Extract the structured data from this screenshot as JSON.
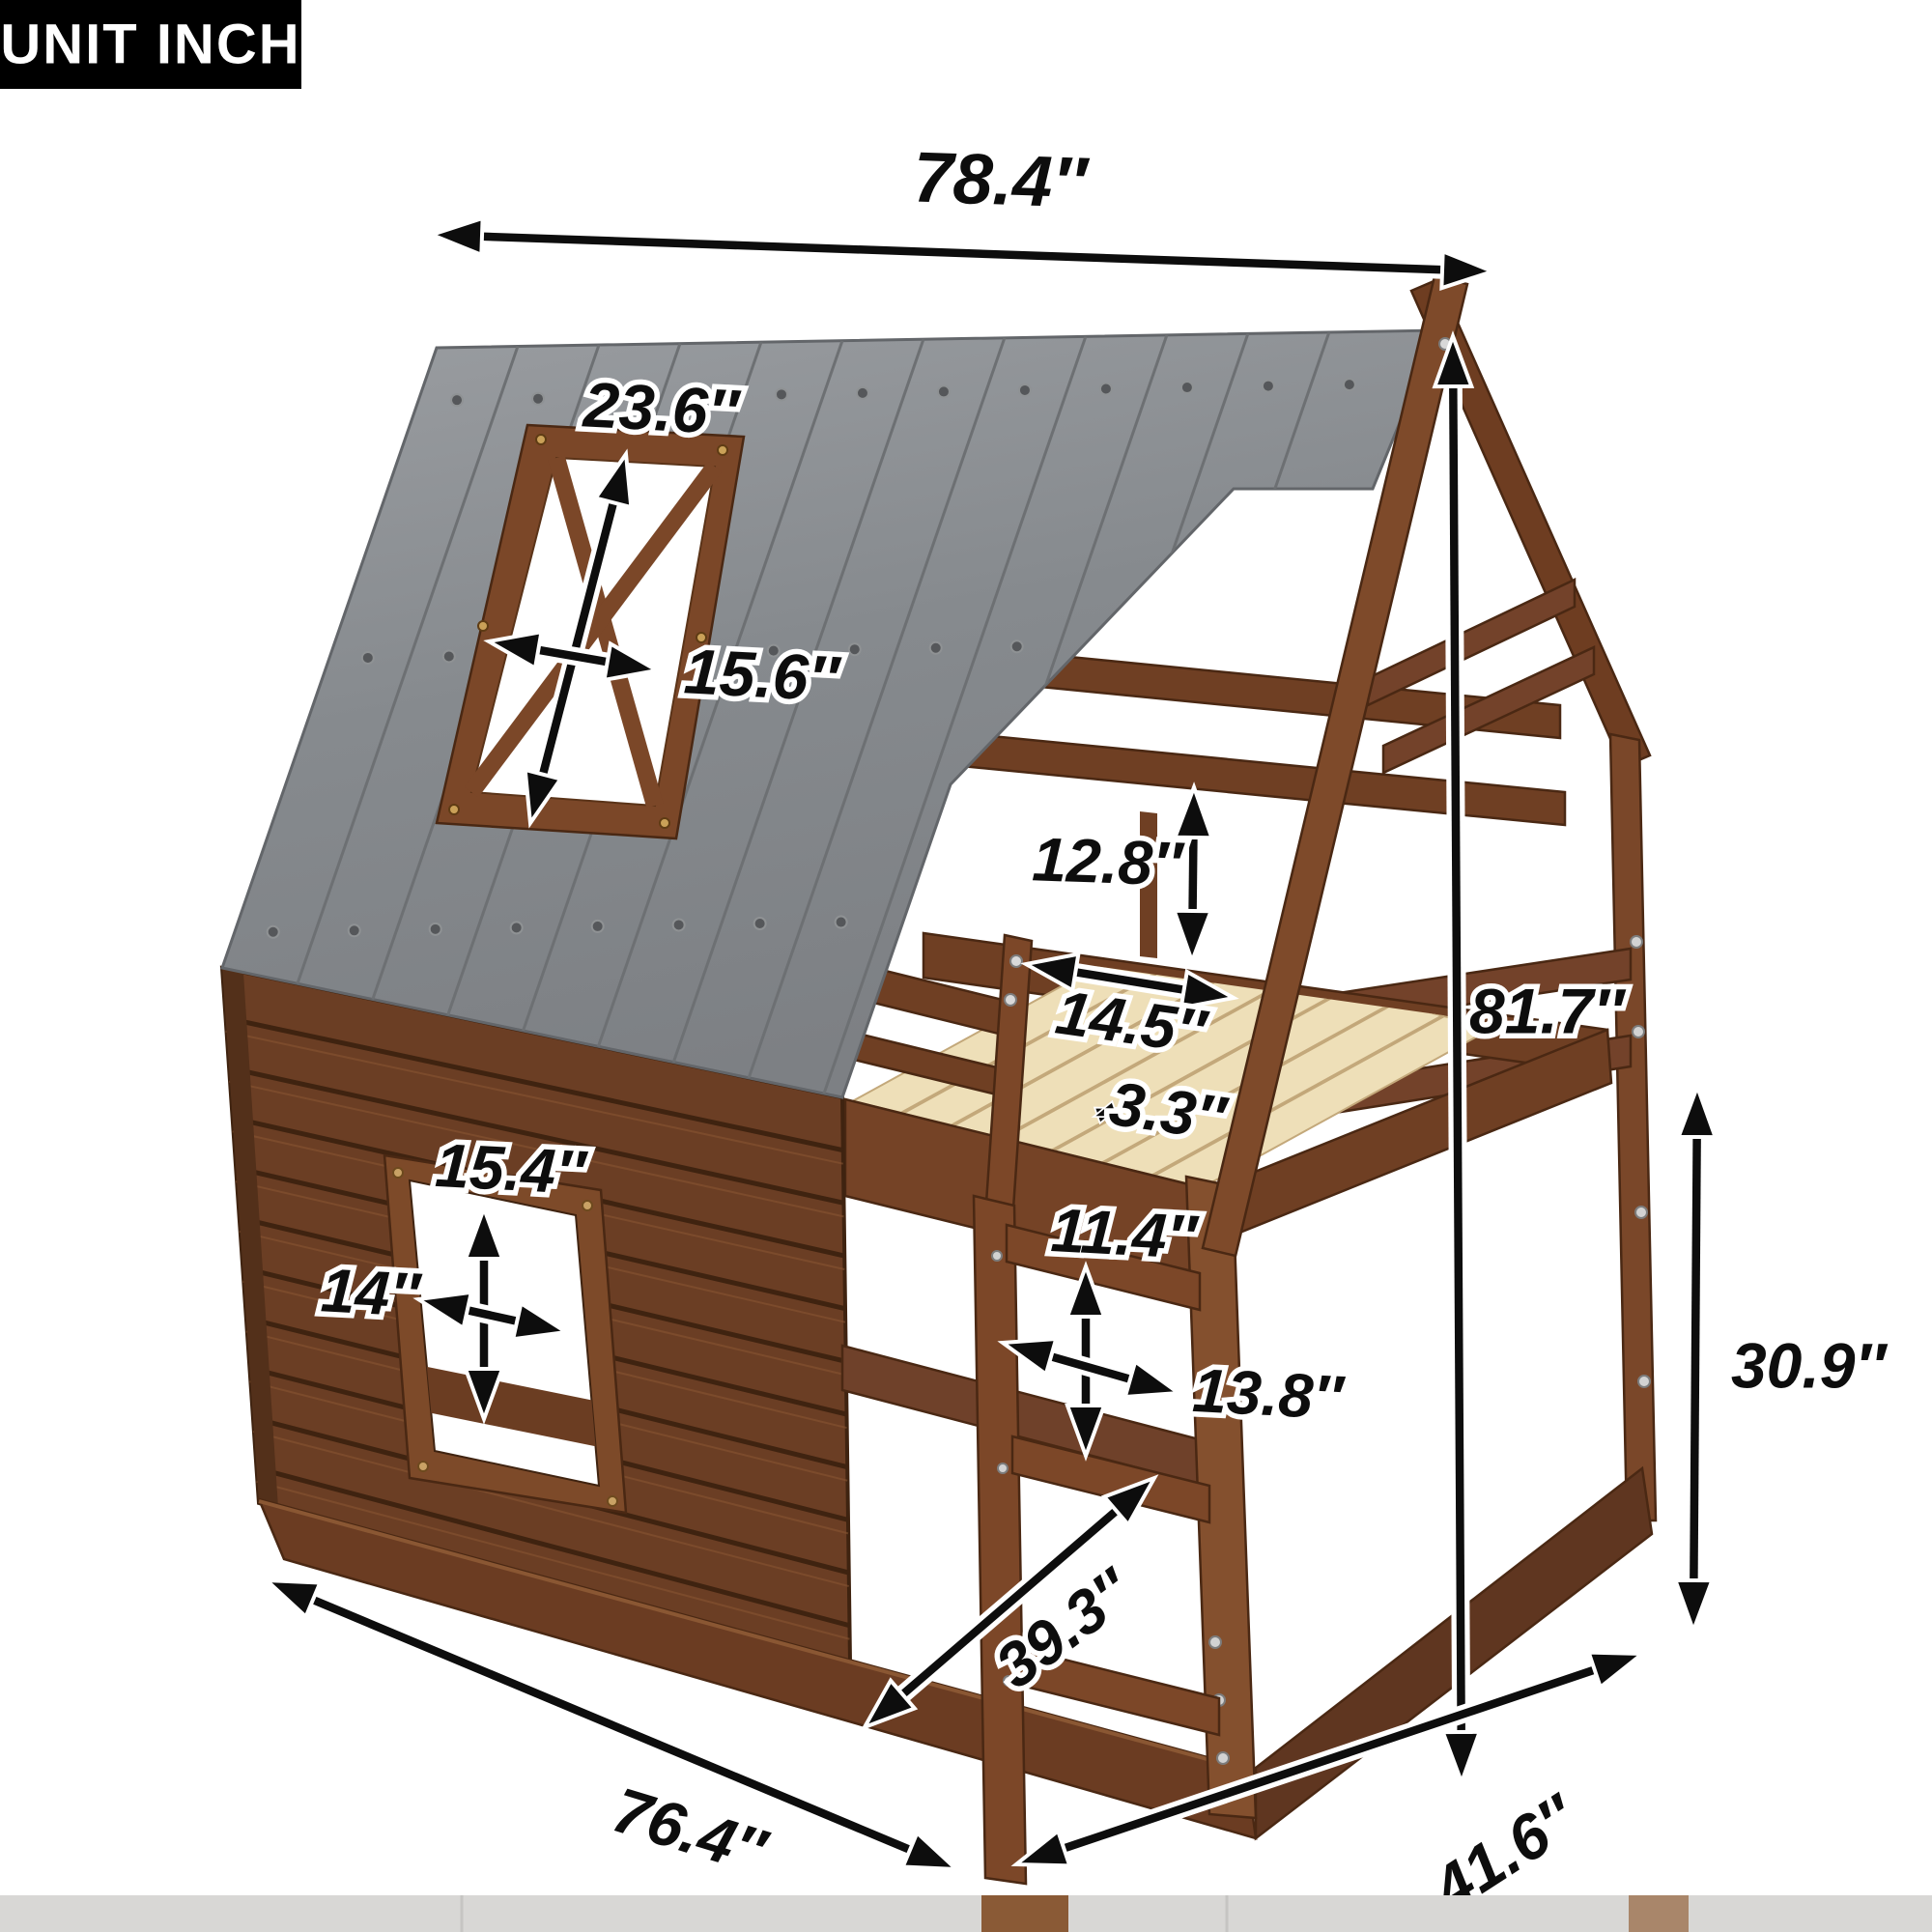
{
  "unit_badge": {
    "label": "UNIT INCH"
  },
  "dimensions": {
    "roof_length": "78.4″",
    "roof_window_height": "23.6″",
    "roof_window_width": "15.6″",
    "guardrail_height": "12.8″",
    "ladder_opening_width": "14.5″",
    "slat_gap": "3.3″",
    "total_height": "81.7″",
    "wall_window_height": "15.4″",
    "wall_window_width": "14″",
    "ladder_rung_spacing": "11.4″",
    "ladder_width": "13.8″",
    "under_bed_clearance": "30.9″",
    "door_diagonal": "39.3″",
    "bed_length": "76.4″",
    "bed_depth": "41.6″"
  },
  "colors": {
    "roof_gray": "#8b8e91",
    "wood_brown": "#7b4728",
    "log_wall": "#6b3e24",
    "slats": "#eedfb8",
    "dimension_ink": "#0d0d0d",
    "badge_bg": "#000000",
    "badge_text": "#ffffff"
  }
}
